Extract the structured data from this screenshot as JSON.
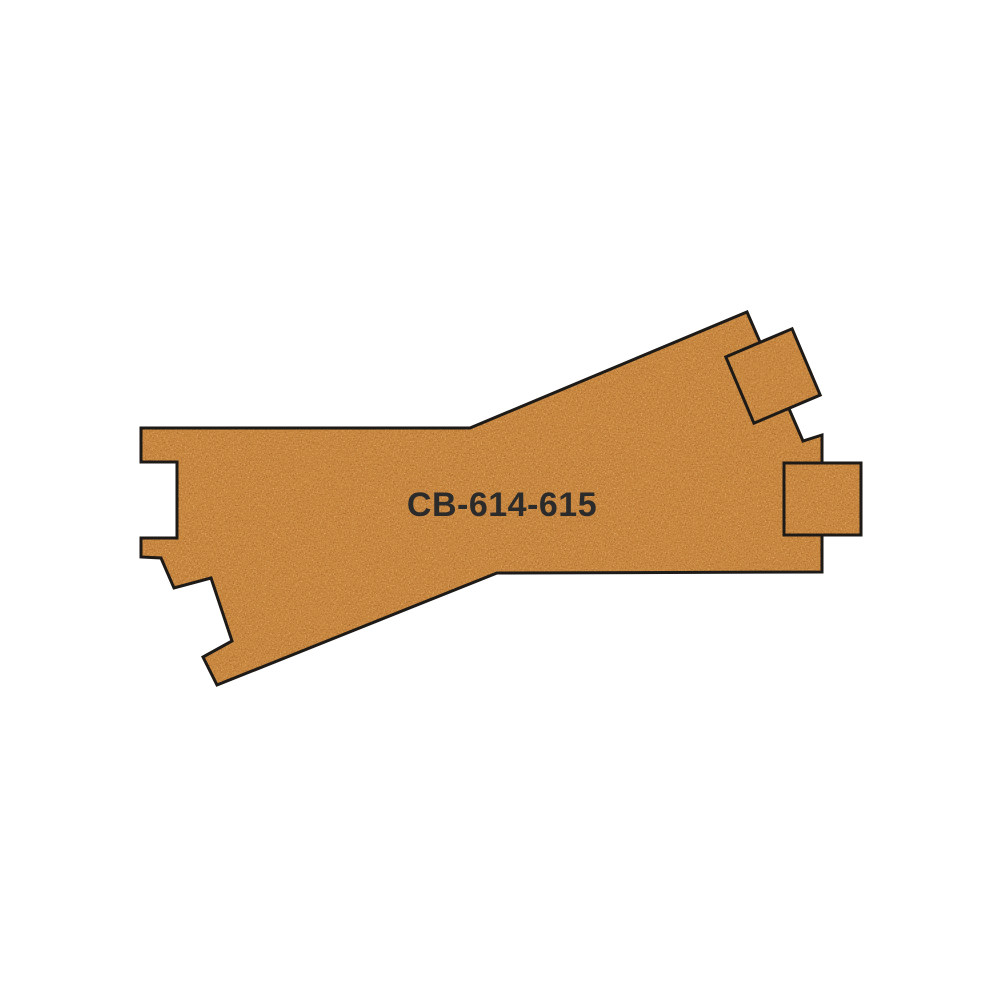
{
  "part": {
    "label": "CB-614-615"
  },
  "colors": {
    "background": "#ffffff",
    "cork_base": "#c9873f",
    "cork_speckle_dark": "#9a5c26",
    "cork_speckle_light": "#eec584",
    "outline": "#1d1a17",
    "label_text": "#2b2b2b"
  }
}
